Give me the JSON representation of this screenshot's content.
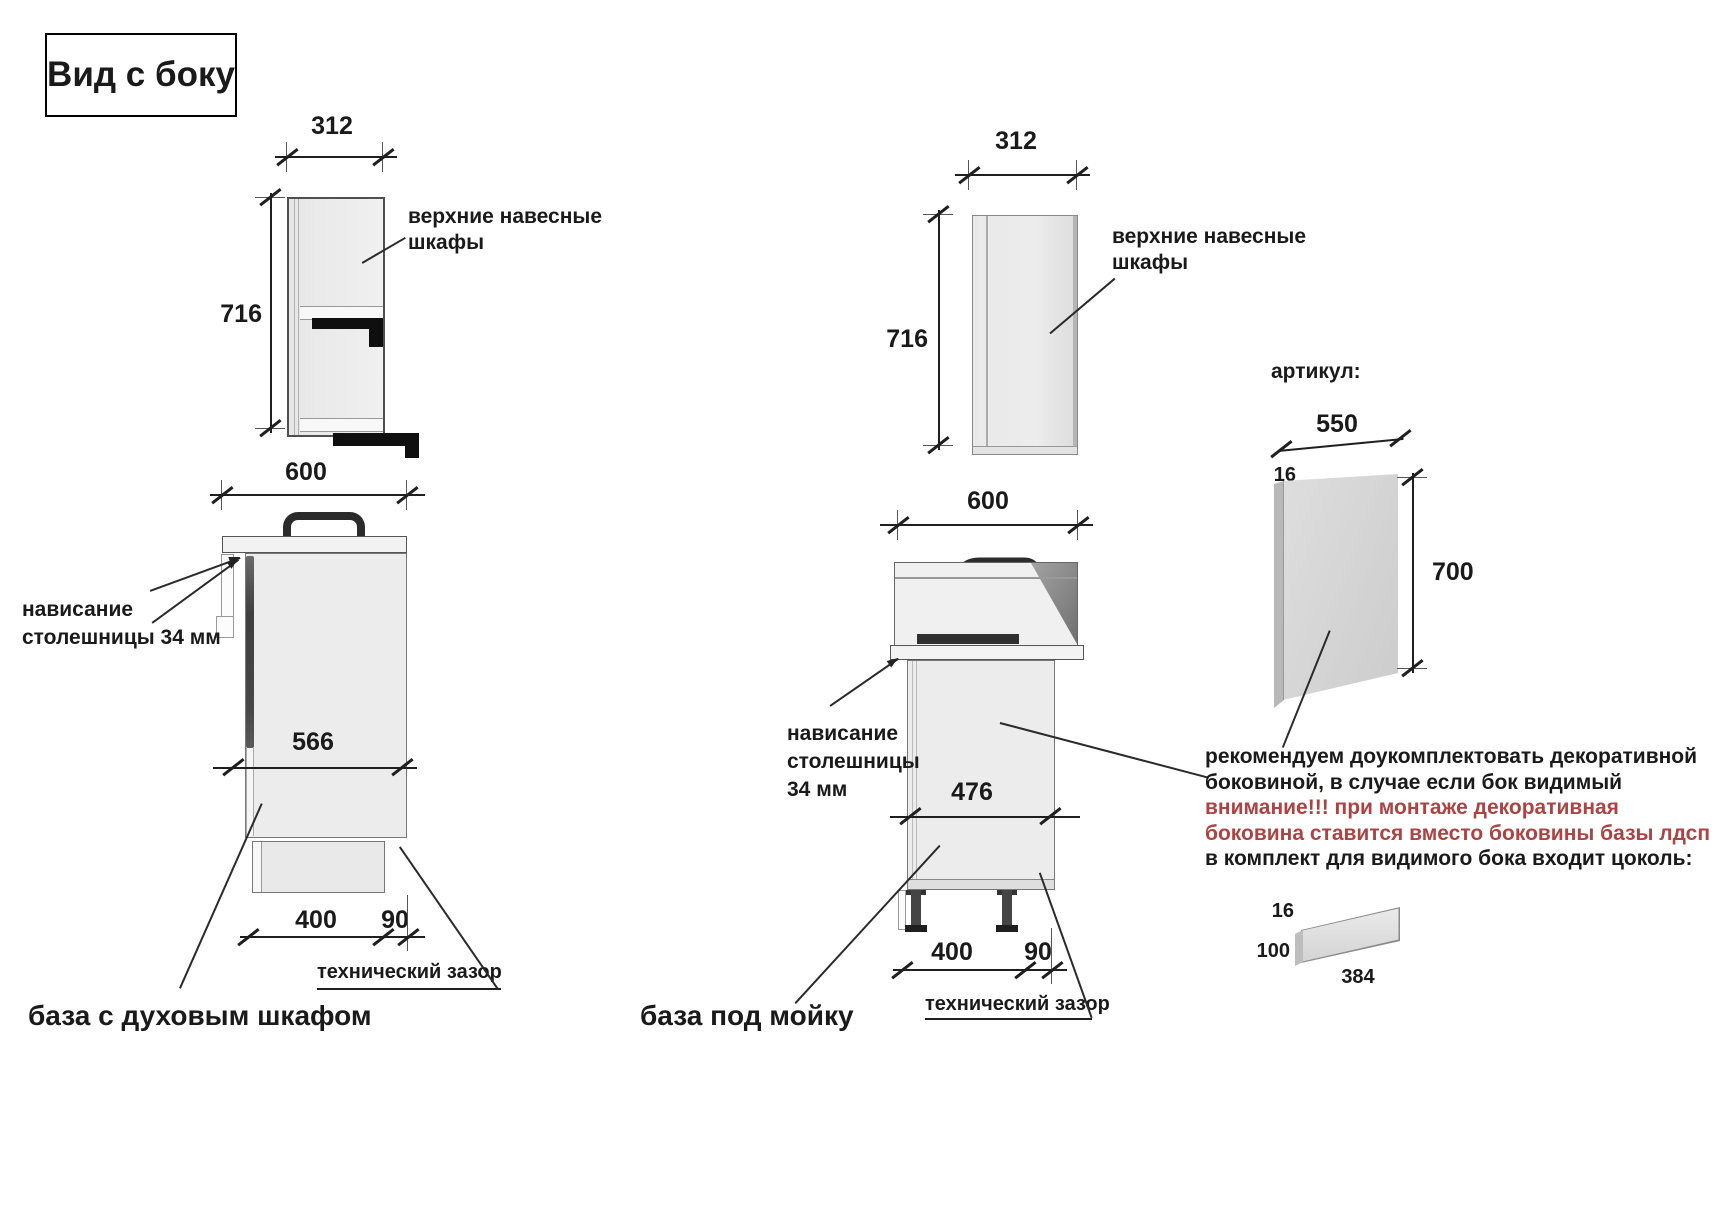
{
  "title": "Вид с боку",
  "colors": {
    "note_red": "#ad4343",
    "drawing_line": "#1f1f1f"
  },
  "wall_cabinet_left": {
    "width": "312",
    "height": "716",
    "label1": "верхние навесные",
    "label2": "шкафы"
  },
  "wall_cabinet_mid": {
    "width": "312",
    "height": "716",
    "label1": "верхние навесные",
    "label2": "шкафы"
  },
  "base_oven": {
    "countertop_depth": "600",
    "body_depth": "566",
    "plinth_recess": "400",
    "gap": "90",
    "overhang1": "нависание",
    "overhang2": "столешницы 34 мм",
    "tech_gap": "технический зазор",
    "caption": "база с духовым шкафом"
  },
  "base_sink": {
    "countertop_depth": "600",
    "body_depth": "476",
    "plinth_recess": "400",
    "gap": "90",
    "overhang1": "нависание",
    "overhang2": "столешницы",
    "overhang3": "34 мм",
    "tech_gap": "технический зазор",
    "caption": "база под мойку"
  },
  "decor_panel": {
    "article": "артикул:",
    "width": "550",
    "thickness": "16",
    "height": "700",
    "note1": "рекомендуем доукомплектовать декоративной",
    "note2": "боковиной, в случае если бок видимый",
    "note3": "внимание!!! при монтаже декоративная",
    "note4": "боковина ставится вместо боковины базы лдсп",
    "note5": "в комплект для видимого бока входит цоколь:"
  },
  "plinth_part": {
    "thickness": "16",
    "height": "100",
    "length": "384"
  }
}
